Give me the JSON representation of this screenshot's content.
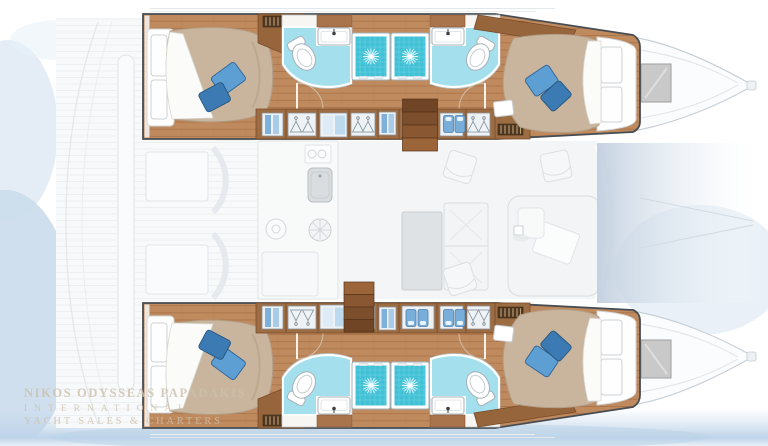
{
  "watermark": {
    "line1": "NIKOS ODYSSEAS PAPADAKIS",
    "line2": "INTERNATIONAL",
    "line3": "YACHT SALES & CHARTERS"
  },
  "vessel_plan": {
    "view": "overhead interior deck plan",
    "vessel_type": "sailing catamaran",
    "hulls": [
      {
        "side": "port (top)",
        "features": [
          "aft double cabin with blue pillows",
          "aft head with toilet and vanity",
          "twin shower stalls",
          "forward head with toilet and vanity",
          "forward double cabin with blue pillows",
          "hanging lockers with clothes",
          "companionway stairs",
          "bow deck hatch"
        ]
      },
      {
        "side": "starboard (bottom)",
        "features": [
          "aft double cabin with blue pillows",
          "aft head with toilet and vanity",
          "twin shower stalls",
          "forward head with toilet and vanity",
          "forward double cabin with blue pillows",
          "hanging lockers with clothes",
          "companionway stairs",
          "bow deck hatch"
        ]
      }
    ],
    "saloon_ghosted": [
      "galley sink",
      "stove burners",
      "dining table",
      "sofa seating",
      "forward lounge",
      "deck chairs",
      "cockpit hatches"
    ],
    "exterior": [
      "aft cockpit (faded)",
      "bow gradient shading between hulls",
      "water shadow along bottom edge"
    ]
  },
  "palette": {
    "hull_outline": "#474d52",
    "wood_floor": "#c08a5f",
    "wood_plank_line": "#a8734a",
    "wood_dark": "#9c6c42",
    "stair_wood": "#7d4e2b",
    "bed_duvet": "#c9b59d",
    "bed_sheet": "#fbfbfa",
    "pillow_blue_light": "#5d9fd3",
    "pillow_blue_dark": "#3b7ab2",
    "bath_floor": "#a3dfec",
    "shower_teal": "#41c1d6",
    "fixture_outline": "#a7b1b8",
    "ghost_line": "#e2e7eb",
    "hatch_gray": "#c9c9c9",
    "water_wash": "#c6d9ec",
    "watermark_color": "#cdc0ab"
  }
}
